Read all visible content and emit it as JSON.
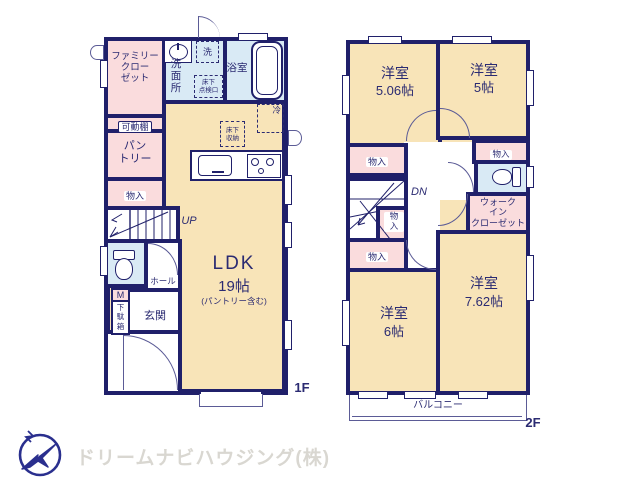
{
  "colors": {
    "wall": "#20206a",
    "room_tan": "#f8e4b8",
    "room_pink": "#fadcdd",
    "room_blue": "#d9eaf5",
    "text_navy": "#2b2b72",
    "logo_navy": "#2a2f8e",
    "footer_text": "#d9d7d1"
  },
  "floor1": {
    "floor_label": "1F",
    "rooms": {
      "family_closet": "ファミリー\nクロー\nゼット",
      "movable_shelf": "可動棚",
      "pantry": "パン\nトリー",
      "storage": "物入",
      "stairs_up": "UP",
      "hall": "ホール",
      "meter": "M",
      "shoe_box": "下\n駄\n箱",
      "entrance": "玄関",
      "washroom": "洗\n面\n所",
      "laundry": "洗",
      "underfloor_hatch": "床下\n点検口",
      "bathroom": "浴室",
      "fridge": "冷",
      "underfloor_storage": "床下\n収納",
      "ldk_name": "LDK",
      "ldk_size": "19帖",
      "ldk_note": "(パントリー含む)"
    }
  },
  "floor2": {
    "floor_label": "2F",
    "rooms": {
      "bedroom1_name": "洋室",
      "bedroom1_size": "5.06帖",
      "bedroom2_name": "洋室",
      "bedroom2_size": "5帖",
      "storage_a": "物入",
      "storage_b": "物入",
      "storage_c": "物\n入",
      "storage_d": "物入",
      "stairs_down": "DN",
      "walk_in_closet": "ウォーク\nイン\nクローゼット",
      "bedroom3_name": "洋室",
      "bedroom3_size": "6帖",
      "bedroom4_name": "洋室",
      "bedroom4_size": "7.62帖",
      "balcony": "バルコニー"
    }
  },
  "footer": {
    "company": "ドリームナビハウジング(株)"
  }
}
